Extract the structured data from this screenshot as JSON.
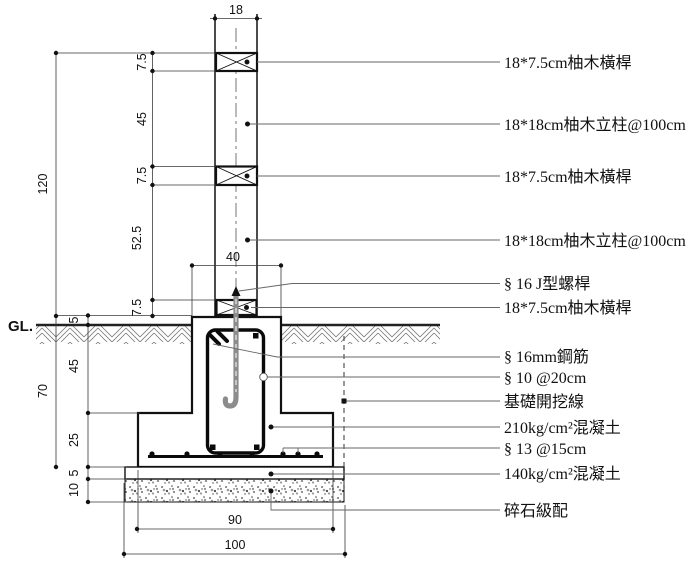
{
  "drawing": {
    "gl_label": "GL.",
    "dims": {
      "post_width": "18",
      "rail_top_h": "7.5",
      "rail_spacing_upper": "45",
      "rail_mid_h": "7.5",
      "rail_spacing_lower": "52.5",
      "total_above_gl": "120",
      "pedestal_width": "40",
      "rail_bottom_h": "7.5",
      "pedestal_above_gl": "5",
      "pedestal_embed": "45",
      "embed_total": "70",
      "footing_h": "25",
      "lean_concrete_h": "5",
      "gravel_h": "10",
      "footing_w": "90",
      "base_w": "100"
    },
    "callouts": {
      "rail_top": "18*7.5cm柚木橫桿",
      "post_upper": "18*18cm柚木立柱@100cm",
      "rail_mid": "18*7.5cm柚木橫桿",
      "post_lower": "18*18cm柚木立柱@100cm",
      "j_bolt": "§ 16 J型螺桿",
      "rail_bottom": "18*7.5cm柚木橫桿",
      "main_rebar": "§ 16mm鋼筋",
      "stirrup": "§ 10 @20cm",
      "excavation_line": "基礎開挖線",
      "concrete_210": "210kg/cm²混凝土",
      "bottom_rebar": "§ 13 @15cm",
      "concrete_140": "140kg/cm²混凝土",
      "gravel": "碎石級配"
    }
  }
}
